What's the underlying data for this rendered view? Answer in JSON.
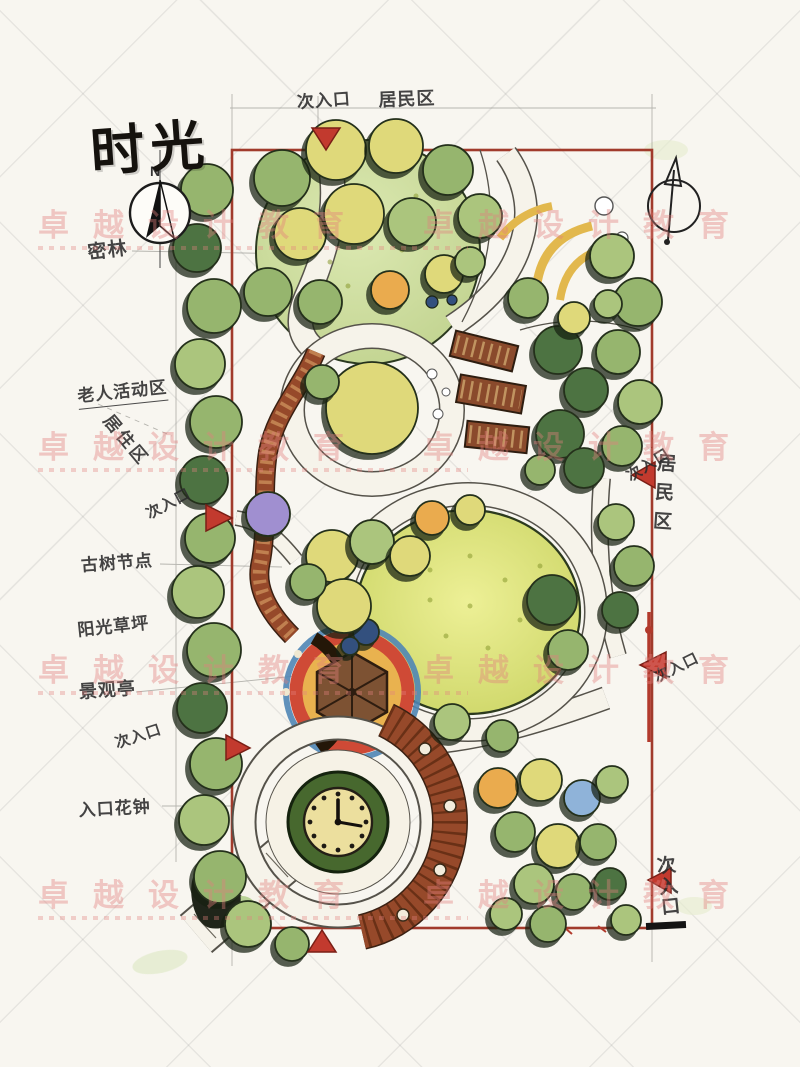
{
  "page": {
    "title_calligraphy": "时光",
    "type_note": "hand-drawn landscape park master plan"
  },
  "compass": {
    "north": "N"
  },
  "watermark": {
    "text": "卓越设计教育",
    "color": "#e2807d"
  },
  "labels": {
    "entrance_top": "次入口",
    "residential_top": "居民区",
    "dense_forest": "密林",
    "elderly_activity_area": "老人活动区",
    "residential_left": "居住区",
    "entrance_left_upper": "次入口",
    "ancient_tree_node": "古树节点",
    "sunny_lawn": "阳光草坪",
    "scenic_pavilion": "景观亭",
    "entrance_left_lower": "次入口",
    "entrance_flower_clock": "入口花钟",
    "residential_right": "居民区",
    "entrance_right_upper": "次入口",
    "entrance_right_middle": "次入口",
    "entrance_right_bottom": "次入口"
  },
  "palette": {
    "boundary_red": "#a13b2c",
    "entrance_marker_red": "#c23a2e",
    "lawn_yellow_green": "#dfe06f",
    "forest_green": "#96b56e",
    "dark_tree_green": "#4d7342",
    "wood_brown": "#96492a",
    "pavilion_ring_blue": "#4f86b5",
    "bench_yellow": "#e2b84d"
  }
}
